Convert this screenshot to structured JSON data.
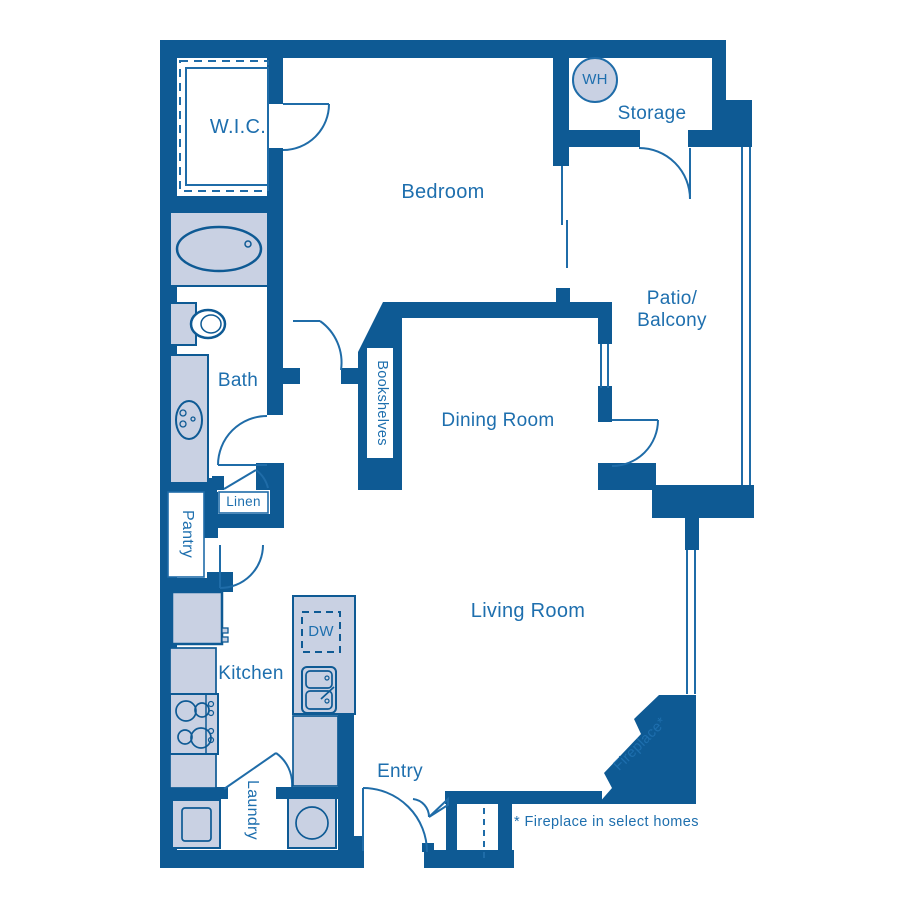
{
  "colors": {
    "wall": "#0E5A94",
    "line": "#1F6CA8",
    "text": "#1E6FAE",
    "fixture_fill": "#C9D1E3",
    "background": "#FFFFFF"
  },
  "labels": {
    "wic": "W.I.C.",
    "bedroom": "Bedroom",
    "storage": "Storage",
    "water_heater": "WH",
    "patio_line1": "Patio/",
    "patio_line2": "Balcony",
    "bath": "Bath",
    "bookshelves": "Bookshelves",
    "dining_room": "Dining Room",
    "linen": "Linen",
    "pantry": "Pantry",
    "kitchen": "Kitchen",
    "dishwasher": "DW",
    "living_room": "Living Room",
    "laundry": "Laundry",
    "entry": "Entry",
    "fireplace": "Fireplace*",
    "footnote": "* Fireplace in select homes"
  }
}
